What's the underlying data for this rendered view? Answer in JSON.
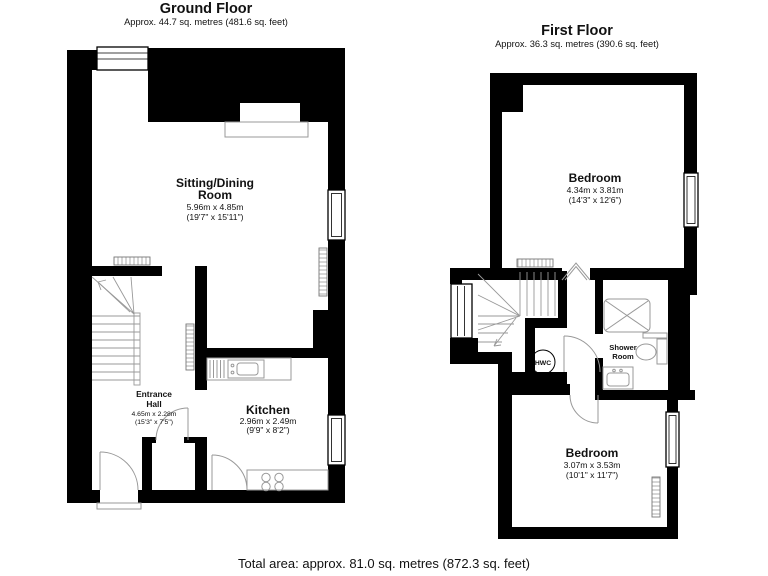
{
  "ground_floor": {
    "title": "Ground Floor",
    "subtitle": "Approx. 44.7 sq. metres (481.6 sq. feet)",
    "sitting_room": {
      "name_line1": "Sitting/Dining",
      "name_line2": "Room",
      "dims_metric": "5.96m x 4.85m",
      "dims_imperial": "(19'7\" x 15'11\")"
    },
    "entrance_hall": {
      "name_line1": "Entrance",
      "name_line2": "Hall",
      "dims_metric": "4.65m x 2.28m",
      "dims_imperial": "(15'3\" x 7'5\")"
    },
    "kitchen": {
      "name": "Kitchen",
      "dims_metric": "2.96m x 2.49m",
      "dims_imperial": "(9'9\" x 8'2\")"
    }
  },
  "first_floor": {
    "title": "First Floor",
    "subtitle": "Approx. 36.3 sq. metres (390.6 sq. feet)",
    "bedroom_top": {
      "name": "Bedroom",
      "dims_metric": "4.34m x 3.81m",
      "dims_imperial": "(14'3\" x 12'6\")"
    },
    "bedroom_bottom": {
      "name": "Bedroom",
      "dims_metric": "3.07m x 3.53m",
      "dims_imperial": "(10'1\" x 11'7\")"
    },
    "shower_room": {
      "name_line1": "Shower",
      "name_line2": "Room"
    },
    "hwc": {
      "label": "HWC"
    }
  },
  "footer": {
    "total_area": "Total area: approx. 81.0 sq. metres (872.3 sq. feet)"
  },
  "colors": {
    "wall": "#000000",
    "background": "#ffffff",
    "fixture_line": "#999999",
    "text": "#111111"
  }
}
